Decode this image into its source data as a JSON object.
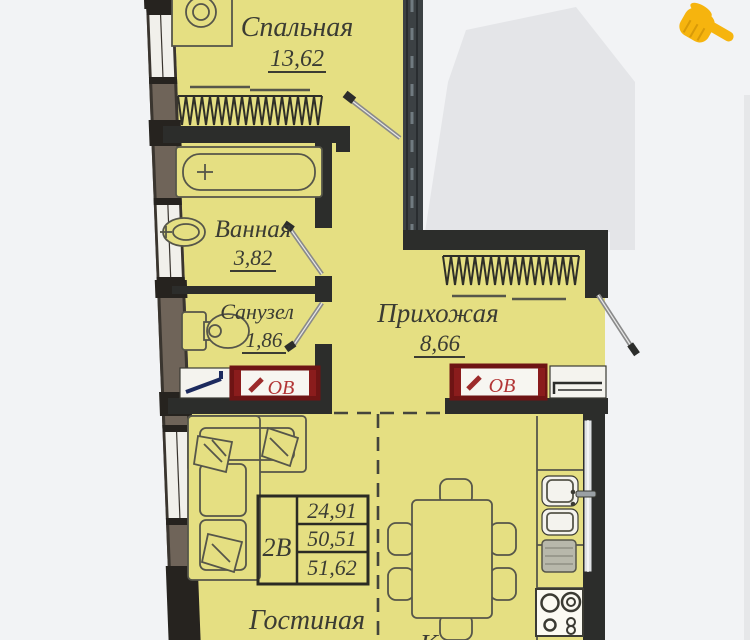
{
  "plan": {
    "rooms": {
      "bedroom": {
        "label": "Спальная",
        "area": "13,62"
      },
      "bathroom": {
        "label": "Ванная",
        "area": "3,82"
      },
      "toilet": {
        "label": "Санузел",
        "area": "1,86"
      },
      "hallway": {
        "label": "Прихожая",
        "area": "8,66"
      },
      "living": {
        "label": "Гостиная"
      },
      "kitchen": {
        "label": "Кухня"
      }
    },
    "spec": {
      "type": "2В",
      "living_area": "24,91",
      "area": "50,51",
      "total": "51,62"
    },
    "radiator_label": "ОВ"
  },
  "colors": {
    "room-fill": "#e5df82",
    "wall-dark": "#2c2d2b",
    "wall-brown": "#6f6459",
    "grey-building": "#e4e5e8",
    "radiator-red": "#6e1414",
    "radiator-text": "#b23535",
    "navy-mark": "#1c2a5e",
    "pointer-yellow": "#f6b40e"
  }
}
